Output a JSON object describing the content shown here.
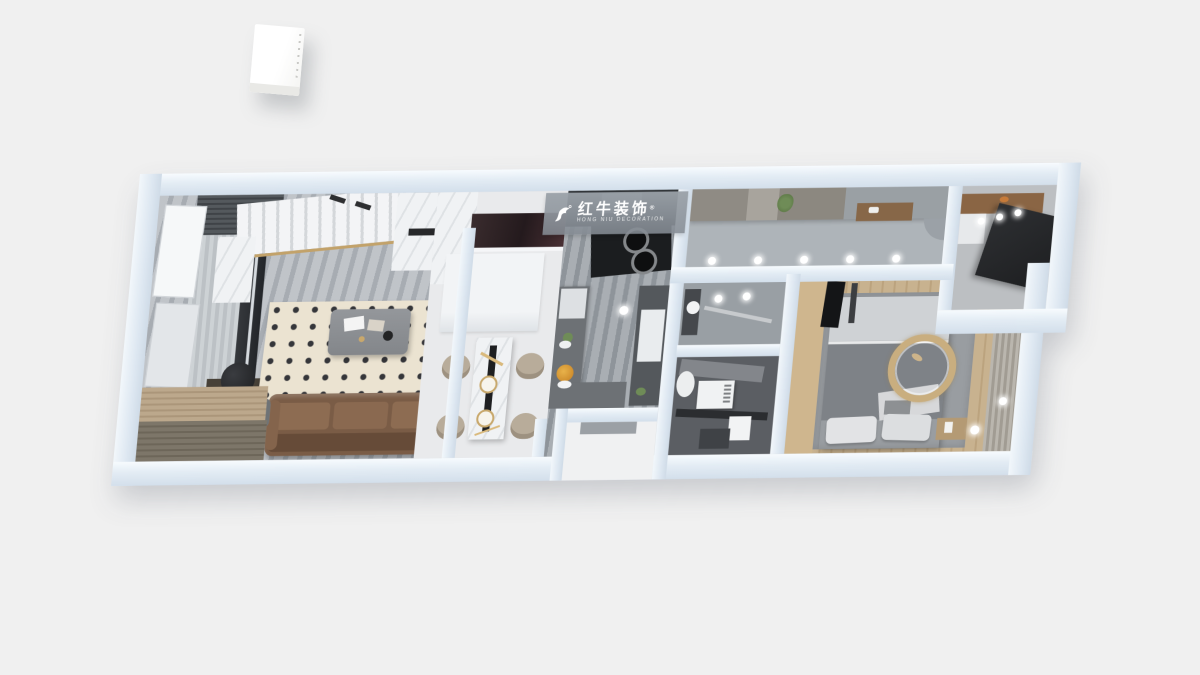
{
  "scene": {
    "type": "3d-apartment-floorplan-render",
    "view": "top-down dollhouse perspective",
    "background_color": "#f0f0f0"
  },
  "watermark": {
    "brand_cn": "红牛装饰",
    "registered_mark": "®",
    "brand_en": "HONG NIU DECORATION"
  },
  "palette": {
    "outer_wall": "#dde7f1",
    "wall_highlight": "#f7fbfe",
    "living_floor_marble": "#b0b5bb",
    "dining_floor": "#e9eaec",
    "kitchen_floor_marble": "#9aa0a6",
    "corridor_floor": "#aeb4b9",
    "bathroom_tile_dark": "#5b5e63",
    "bedroom_wood": "#c3ab86",
    "rug_cream": "#ebe3d1",
    "rug_gray": "#999da1",
    "sofa_leather_brown": "#7a5c46",
    "counter_dark": "#6d7175",
    "gold_accent": "#c9ae7f"
  },
  "icons": {
    "bull_logo_icon": "white stylized leaping bull swoosh",
    "downlight_icon": "small glowing white circle",
    "stove_burner_icon": "concentric dark circles"
  }
}
